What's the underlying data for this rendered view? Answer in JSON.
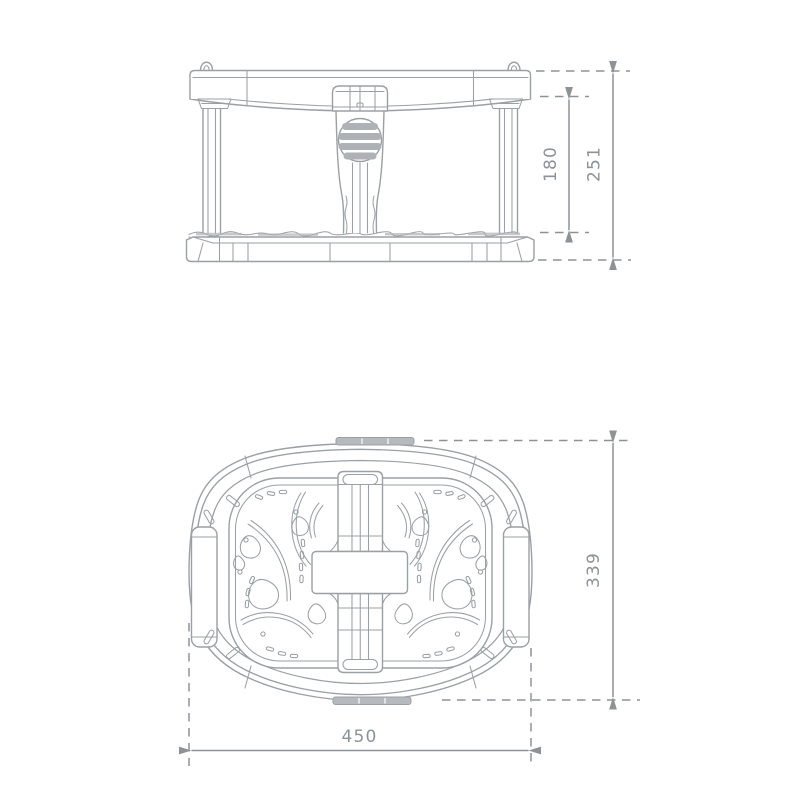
{
  "colors": {
    "background": "#ffffff",
    "outline": "#9ba0a4",
    "dimension": "#8d9297",
    "shading": "#aeb2b6"
  },
  "views": {
    "side_view": {
      "dimensions": {
        "inner_height": "180",
        "overall_height": "251"
      }
    },
    "top_view": {
      "dimensions": {
        "depth": "339",
        "width": "450"
      }
    }
  }
}
